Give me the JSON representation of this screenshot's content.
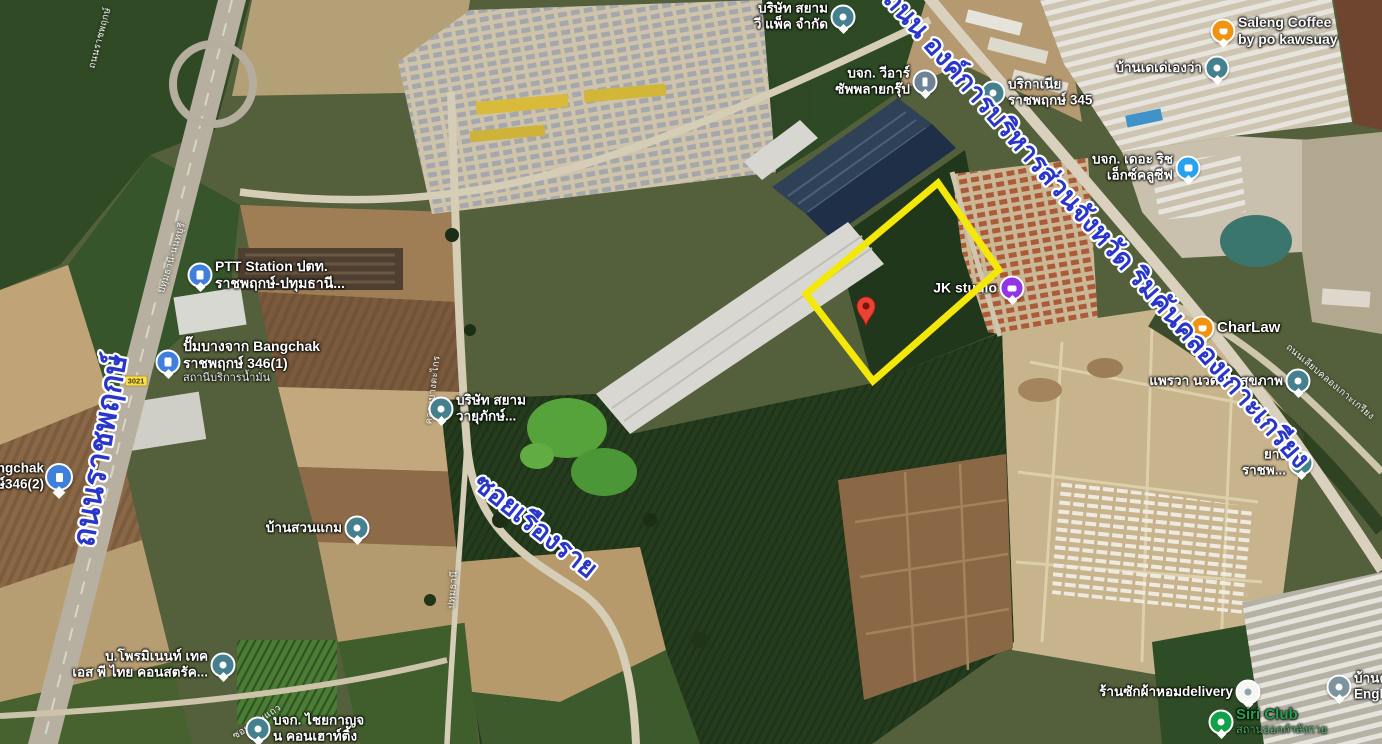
{
  "app": {
    "type": "satellite-map-view"
  },
  "colors": {
    "parcel_outline": "#f4e70a",
    "pin_red": "#ea4335",
    "road_label_blue": "#2836cc",
    "poi_label_white": "#ffffff",
    "park_label_green": "#23a550"
  },
  "parcel": {
    "outline_points": "938,183 999,270 873,381 806,294",
    "pin": {
      "x": 866,
      "y": 306
    }
  },
  "road_labels_major": [
    {
      "id": "ratchaphruek",
      "text": "ถนนราชพฤกษ์",
      "x": 110,
      "y": 452,
      "rotate": -80,
      "size": 31
    },
    {
      "id": "provincial-administration-road",
      "text": "ถนน องค์การบริหารส่วนจังหวัด ริมคันคลองเกาะเกรียง",
      "x": 1090,
      "y": 235,
      "rotate": 48.5,
      "size": 27
    },
    {
      "id": "soi-rueang-rai",
      "text": "ซอยเรืองราย",
      "x": 530,
      "y": 533,
      "rotate": 38.5,
      "size": 27
    }
  ],
  "road_labels_minor": [
    {
      "text": "ถนนเลียบคลองเกาะเกรียง",
      "x": 1330,
      "y": 382,
      "rotate": 40
    },
    {
      "text": "ปทุมธานี-นนทบุรี",
      "x": 172,
      "y": 258,
      "rotate": -73
    },
    {
      "text": "คลองบางตะไกร",
      "x": 433,
      "y": 390,
      "rotate": -83
    },
    {
      "text": "ปทุมธานี",
      "x": 453,
      "y": 590,
      "rotate": -85
    },
    {
      "text": "ซอยอ้อมแถว",
      "x": 257,
      "y": 722,
      "rotate": -33
    },
    {
      "text": "ถนนราชพฤกษ์",
      "x": 100,
      "y": 38,
      "rotate": -75
    }
  ],
  "route_shield": {
    "text": "3021",
    "x": 136,
    "y": 381
  },
  "pois": [
    {
      "id": "saleng-coffee",
      "x": 1223,
      "y": 31,
      "icon": "cafe-orange",
      "side": "right",
      "size": 14,
      "lines": [
        "Saleng Coffee",
        "by po kawsuay"
      ]
    },
    {
      "id": "baan-te-te",
      "x": 1217,
      "y": 68,
      "icon": "place-teal",
      "side": "left",
      "lines": [
        "บ้านเดเด่เองว่า"
      ]
    },
    {
      "id": "siam-v-pack",
      "x": 843,
      "y": 17,
      "icon": "place-teal",
      "side": "left",
      "lines": [
        "บริษัท สยาม",
        "วี แพ็ค จำกัด"
      ]
    },
    {
      "id": "vr-supply-group",
      "x": 925,
      "y": 82,
      "icon": "company-slate",
      "side": "left",
      "lines": [
        "บจก. วีอาร์",
        "ซัพพลายกรุ๊ป"
      ]
    },
    {
      "id": "brikania-ratchaphruek-345",
      "x": 993,
      "y": 93,
      "icon": "place-teal",
      "side": "right",
      "lines": [
        "บริกาเนีย",
        "ราชพฤกษ์ 345"
      ]
    },
    {
      "id": "the-rich-exclusive",
      "x": 1188,
      "y": 168,
      "icon": "lodging-blue",
      "side": "left",
      "lines": [
        "บจก. เดอะ ริช",
        "เอ็กซ์คลูซีฟ"
      ]
    },
    {
      "id": "jk-studio",
      "x": 1012,
      "y": 288,
      "icon": "studio-purple",
      "side": "left",
      "size": 14,
      "lines": [
        "JK studio"
      ]
    },
    {
      "id": "charlaw",
      "x": 1202,
      "y": 328,
      "icon": "cafe-orange",
      "side": "right",
      "size": 15,
      "lines": [
        "CharLaw"
      ]
    },
    {
      "id": "praewa-massage",
      "x": 1298,
      "y": 381,
      "icon": "place-teal",
      "side": "left",
      "lines": [
        "แพรวา นวดเพื่อสุขภาพ"
      ]
    },
    {
      "id": "ptt-station",
      "x": 200,
      "y": 275,
      "icon": "fuel-blue",
      "side": "right",
      "size": 14,
      "lines": [
        "PTT Station ปตท.",
        "ราชพฤกษ์-ปทุมธานี..."
      ]
    },
    {
      "id": "bangchak-346-1",
      "x": 168,
      "y": 362,
      "icon": "fuel-blue",
      "side": "right",
      "size": 14,
      "lines": [
        "ปั๊มบางจาก Bangchak",
        "ราชพฤกษ์ 346(1)"
      ],
      "sub": "สถานีบริการน้ำมัน"
    },
    {
      "id": "bangchak-346-2",
      "x": 59,
      "y": 477,
      "icon": "fuel-pin-blue",
      "side": "left",
      "lines": [
        "Bangchak",
        "กษ์346(2)"
      ]
    },
    {
      "id": "baan-suan-kaem",
      "x": 357,
      "y": 528,
      "icon": "place-teal",
      "side": "left",
      "lines": [
        "บ้านสวนแกม"
      ]
    },
    {
      "id": "siam-wayupak",
      "x": 441,
      "y": 409,
      "icon": "place-teal",
      "side": "right",
      "lines": [
        "บริษัท สยาม",
        "วายุภักษ์..."
      ]
    },
    {
      "id": "prominent-tech",
      "x": 223,
      "y": 665,
      "icon": "place-teal",
      "side": "left",
      "lines": [
        "บ.โพรมิเนนท์ เทค",
        "เอส พี ไทย คอนสตรัค..."
      ]
    },
    {
      "id": "chaiyakan-consulting",
      "x": 258,
      "y": 729,
      "icon": "place-teal",
      "side": "right",
      "lines": [
        "บจก. ไชยกาญจ",
        "น คอนเฮาท์ติ้ง"
      ]
    },
    {
      "id": "laundry-delivery",
      "x": 1248,
      "y": 692,
      "icon": "place-light",
      "side": "left",
      "lines": [
        "ร้านซักผ้าหอมdelivery"
      ]
    },
    {
      "id": "baan-kru-english",
      "x": 1339,
      "y": 687,
      "icon": "place-gray",
      "side": "right",
      "lines": [
        "บ้านครู",
        "English"
      ]
    },
    {
      "id": "siri-club",
      "x": 1221,
      "y": 722,
      "icon": "park-green",
      "side": "right",
      "size": 15,
      "color": "#23a550",
      "lines": [
        "Siri Club"
      ],
      "sub": "สถานออกกำลังกาย",
      "subColor": "#49b86d"
    },
    {
      "id": "yang-ratchaphruek",
      "x": 1301,
      "y": 463,
      "icon": "place-teal",
      "side": "left",
      "lines": [
        "ยาง",
        "ราชพ..."
      ]
    }
  ]
}
